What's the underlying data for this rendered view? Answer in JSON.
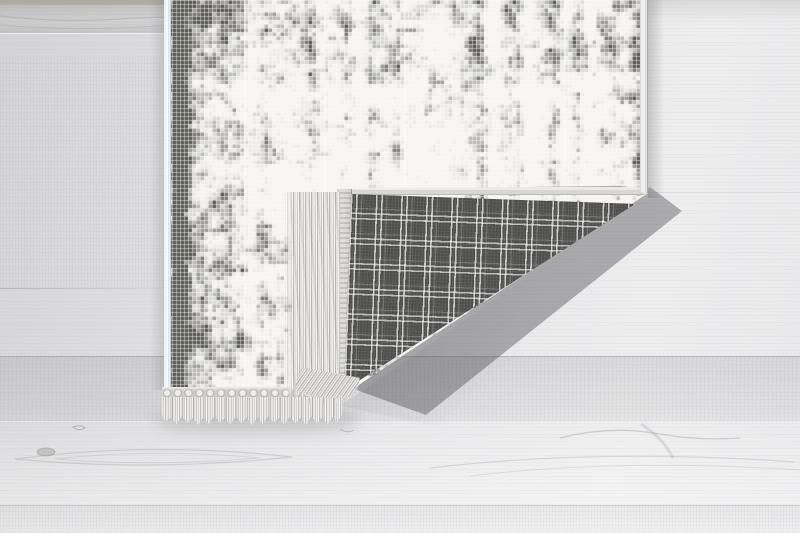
{
  "scene": {
    "description": "Product photo of a white-grey pixel-mosaic rug lying on a pale wooden floor; the bottom-right corner is folded over revealing a dark grey windowpane-check woven backing; white twisted tassel fringe runs along the rug's bottom edge and along the folded flap edge; soft shadows are cast on the floor.",
    "parts": {
      "floor": "pale grey wooden floor with horizontal grain, plank lines and knots",
      "rug_top": "white and grey pixel-mosaic patterned pile with light edge binding",
      "rug_backing": "dark grey plaid / windowpane-check anti-slip backing on folded corner",
      "fringe_bottom": "white tassel fringe with knotted loop row along bottom edge",
      "fringe_fold": "fringe strands of the folded corner draped vertically",
      "shadow": "soft diagonal shadow under the lifted folded corner"
    },
    "text_content": "none"
  },
  "theme": {
    "--floor-base": "#e2e2e4",
    "--floor-dark": "#d4d4d6",
    "--floor-light": "#eeeeef",
    "--top-strip": "#c2bcb0",
    "--mosaic-base": "#f6f5f2",
    "--plaid-base": "#4d4d4b",
    "--plaid-line": "#fafaf8",
    "--binding": "#d8d7d3",
    "--fringe-light": "#eeede9",
    "--fringe-dark": "#b6b5b1",
    "--shadow-strong": "rgba(70,70,78,0.40)",
    "--shadow-soft": "rgba(110,110,118,0.25)"
  },
  "mosaic": {
    "cell_px": 4,
    "palette": [
      "#f6f5f2",
      "#eeede9",
      "#dbdad6",
      "#bab9b5",
      "#9a9995",
      "#787773",
      "#57564f"
    ],
    "grid_line": "rgba(252,252,250,0.5)",
    "panel_seam": "rgba(255,255,255,0.35)",
    "panel_seam_spacing_px": 80
  }
}
